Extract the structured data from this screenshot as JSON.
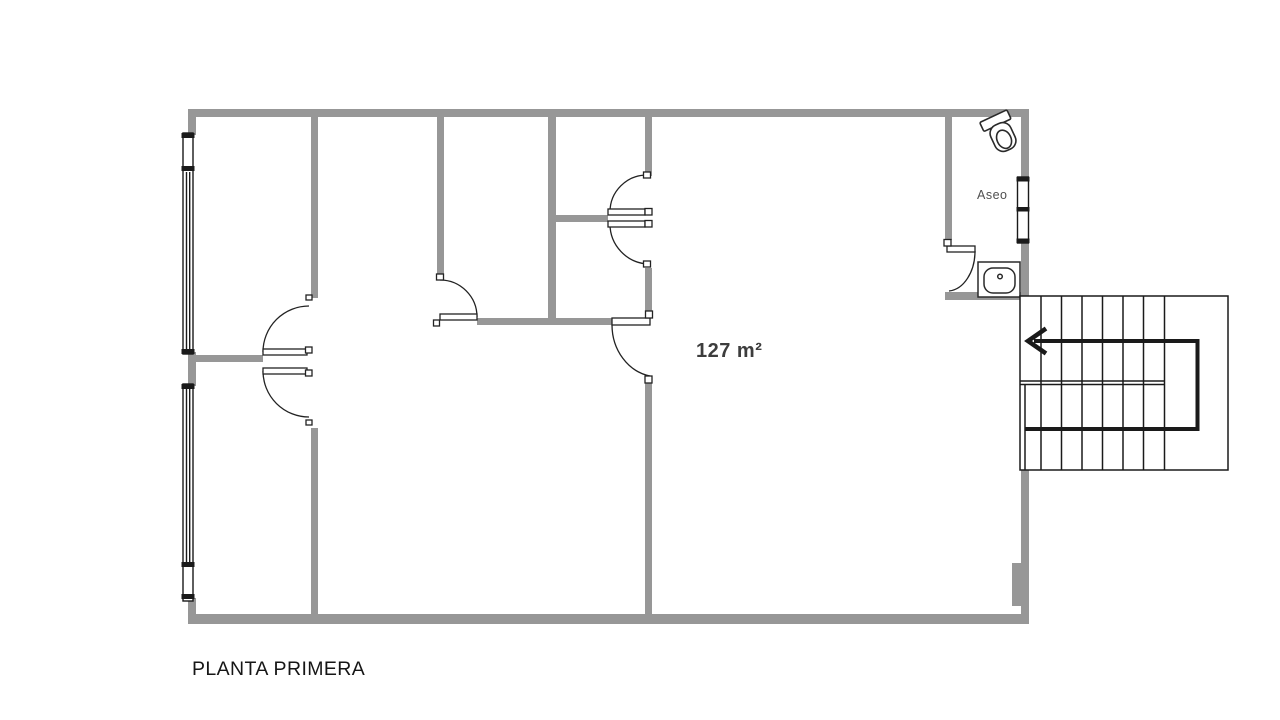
{
  "floor_plan": {
    "title": "PLANTA PRIMERA",
    "area_label": "127 m²",
    "rooms": [
      {
        "name": "Aseo"
      }
    ],
    "fixtures": {
      "bathroom": [
        "toilet-icon",
        "sink-icon"
      ],
      "stairs": {
        "icon": "staircase",
        "direction_arrow": "left",
        "flights": 3
      },
      "windows": [
        "left-wall-window",
        "right-wall-window"
      ],
      "doors": [
        "double-swing-door-left",
        "corridor-door",
        "closet-door-upper",
        "closet-door-lower",
        "center-room-door",
        "bathroom-door"
      ]
    },
    "colors": {
      "wall_gray": "#979797",
      "line_black": "#1a1a1a",
      "title_text": "#161616",
      "area_text": "#3d3d3d",
      "room_text": "#4f4f4f",
      "background": "#ffffff"
    }
  }
}
